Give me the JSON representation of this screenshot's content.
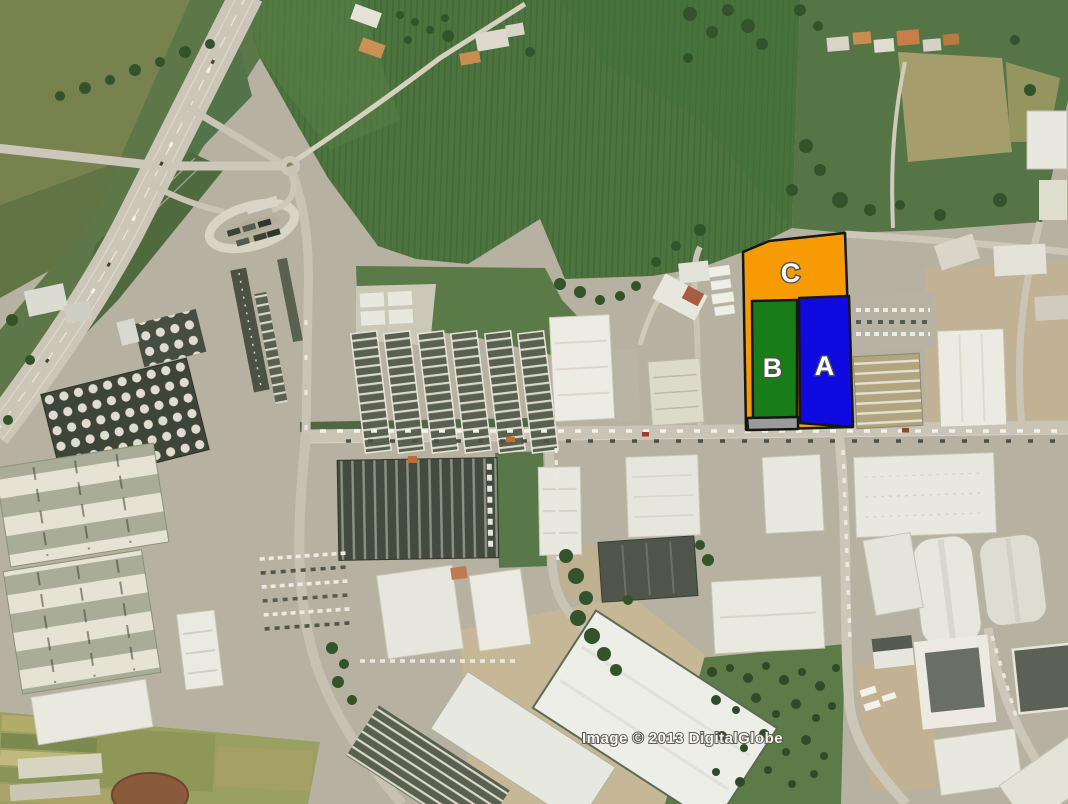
{
  "map": {
    "type": "satellite-aerial",
    "scene": "Industrial park beside a highway interchange with farm fields; three land parcels highlighted",
    "attribution": "Image © 2013 DigitalGlobe",
    "parcel_overlays": {
      "label_fill": "#ffffff",
      "label_outline": "#4f4f4f",
      "outline": "#161616",
      "parcels": [
        {
          "id": "C",
          "label": "C",
          "fill": "#f79b04",
          "points": "743,252 769,241 845,233 852,427 746,430",
          "label_x": 791,
          "label_y": 282
        },
        {
          "id": "B",
          "label": "B",
          "fill": "#187c18",
          "points": "752,301 797,300 797,419 753,419",
          "label_x": 773,
          "label_y": 377
        },
        {
          "id": "A",
          "label": "A",
          "fill": "#0f0adf",
          "points": "799,298 849,296 853,427 800,423",
          "label_x": 825,
          "label_y": 375
        },
        {
          "id": "access-strip",
          "label": "",
          "fill": "#9b9b9b",
          "points": "747,418 798,417 798,429 748,430"
        }
      ]
    }
  }
}
